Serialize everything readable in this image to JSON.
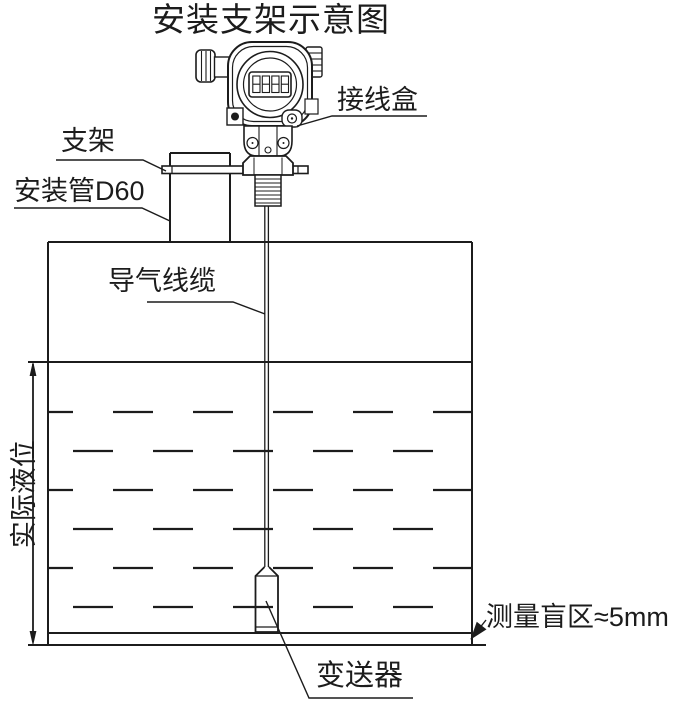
{
  "title": "安装支架示意图",
  "diagram": {
    "type": "installation-schematic",
    "labels": {
      "junction_box": "接线盒",
      "bracket": "支架",
      "mounting_pipe": "安装管D60",
      "air_cable": "导气线缆",
      "actual_level": "实际液位",
      "blind_zone": "测量盲区≈5mm",
      "transmitter": "变送器"
    },
    "icons": {
      "transmitter_head": "pressure-transmitter-with-lcd-icon",
      "lcd_display_digits": "8888"
    },
    "colors": {
      "line": "#1c1c1c",
      "background": "#ffffff"
    }
  }
}
